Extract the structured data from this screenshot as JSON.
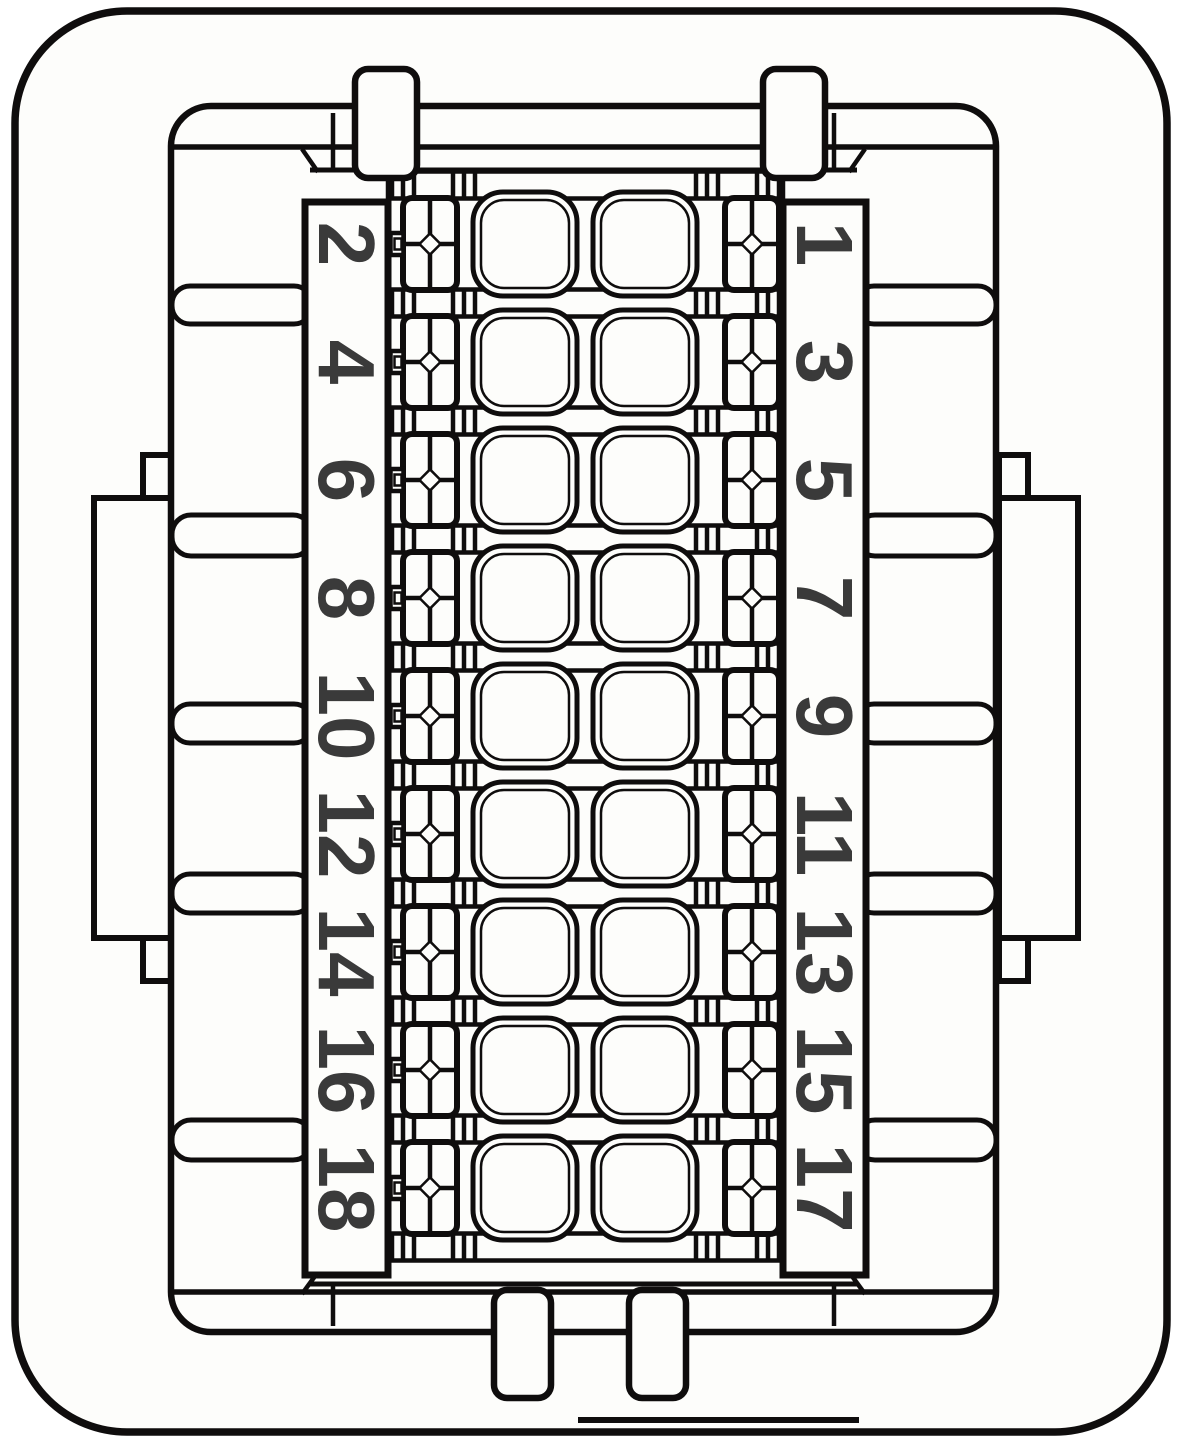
{
  "diagram": {
    "type": "connector-pinout",
    "pin_count": 18,
    "rows": 9,
    "columns": 2,
    "pins": {
      "left": [
        "2",
        "4",
        "6",
        "8",
        "10",
        "12",
        "14",
        "16",
        "18"
      ],
      "right": [
        "1",
        "3",
        "5",
        "7",
        "9",
        "11",
        "13",
        "15",
        "17"
      ]
    },
    "colors": {
      "line": "#0f0d0d",
      "digit": "#3a3a3a",
      "surface": "#fdfdfb",
      "background": "#ffffff"
    }
  }
}
